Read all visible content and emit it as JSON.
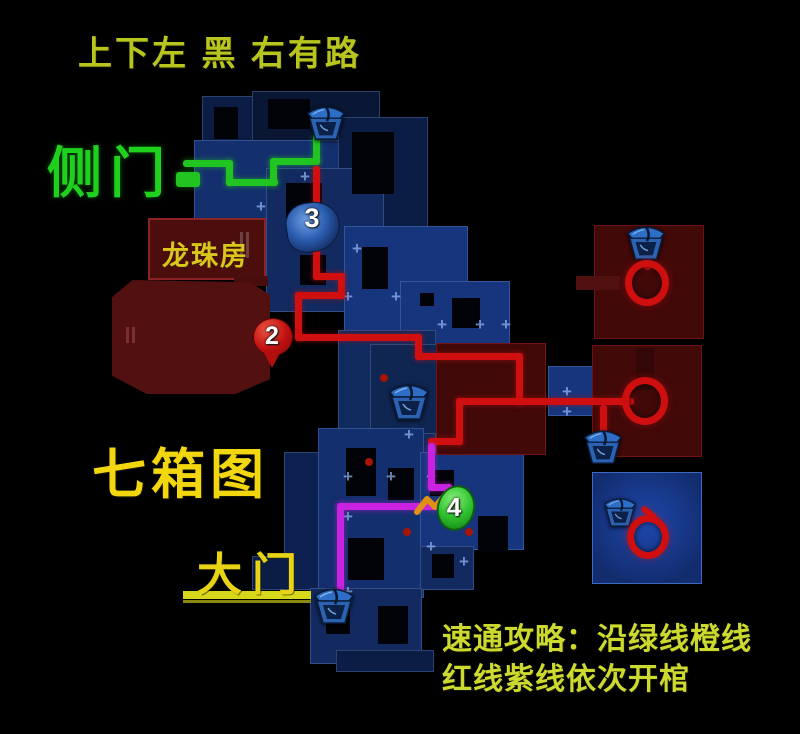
{
  "annotations": {
    "top_hint": "上下左 黑 右有路",
    "side_door": "侧门",
    "dragon_room": "龙珠房",
    "seven_box_map": "七箱图",
    "main_gate": "大门",
    "guide_line1": "速通攻略：沿绿线橙线",
    "guide_line2": "红线紫线依次开棺"
  },
  "markers": {
    "m2": "2",
    "m3": "3",
    "m4": "4"
  },
  "colors": {
    "background": "#000000",
    "route_green": "#21c421",
    "route_red": "#d01010",
    "route_purple": "#c922e0",
    "route_orange": "#e09012",
    "label_yellow": "#f2d70e",
    "hint_yellow_green": "#b9c51f",
    "side_door_green": "#1dd11d",
    "guide_text_color": "#ccd92e",
    "room_blue": "#16357c",
    "boss_room_red": "#420909",
    "ring_red": "#cf0f0f",
    "coffin_blue": "#2e6ec6"
  },
  "icons": {
    "coffin": "coffin-icon",
    "ring": "red-circle-annotation",
    "pin2": "red-map-pin",
    "pin3": "blue-beast-marker",
    "pin4": "green-blob-marker"
  }
}
